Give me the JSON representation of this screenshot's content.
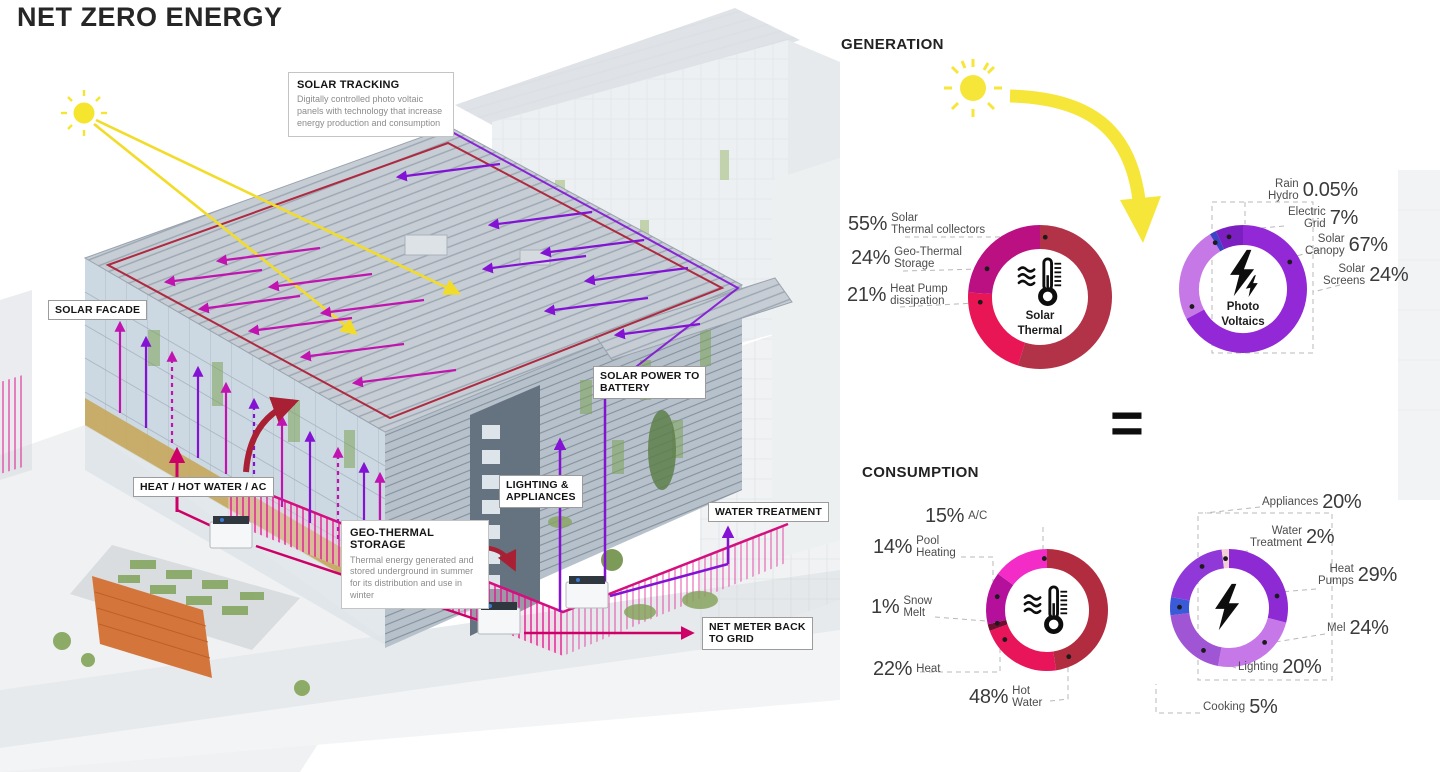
{
  "title": "NET ZERO ENERGY",
  "equals_sign": "=",
  "diagram": {
    "callouts": {
      "solar_tracking": {
        "title": "SOLAR TRACKING",
        "body": "Digitally controlled photo voltaic panels with technology that increase energy production and consumption"
      },
      "geo_thermal": {
        "title": "GEO-THERMAL\nSTORAGE",
        "body": "Thermal energy generated and stored underground in summer for its distribution and use in winter"
      }
    },
    "labels": {
      "solar_facade": "SOLAR  FACADE",
      "heat_hot_water_ac": "HEAT / HOT WATER / AC",
      "solar_power_to_battery": "SOLAR POWER TO\nBATTERY",
      "lighting_appliances": "LIGHTING &\nAPPLIANCES",
      "water_treatment": "WATER TREATMENT",
      "net_meter": "NET METER BACK\nTO GRID"
    }
  },
  "generation": {
    "heading": "GENERATION"
  },
  "consumption": {
    "heading": "CONSUMPTION"
  },
  "chart_data": [
    {
      "id": "gen-thermal",
      "type": "pie",
      "section": "GENERATION",
      "center_label": "Solar\nThermal",
      "icon": "thermometer-icon",
      "segments": [
        {
          "label": "Solar Thermal collectors",
          "value": 55,
          "display_value": "55%",
          "display_name": "Solar\nThermal collectors",
          "color": "#b23247",
          "dot": 5
        },
        {
          "label": "Heat Pump dissipation",
          "value": 21,
          "display_value": "21%",
          "display_name": "Heat Pump\ndissipation",
          "color": "#e91656",
          "dot": 265
        },
        {
          "label": "Geo-Thermal Storage",
          "value": 24,
          "display_value": "24%",
          "display_name": "Geo-Thermal\nStorage",
          "color": "#ba1082",
          "dot": 298
        }
      ]
    },
    {
      "id": "gen-pv",
      "type": "pie",
      "section": "GENERATION",
      "center_label": "Photo\nVoltaics",
      "icon": "lightning-icon",
      "segments": [
        {
          "label": "Solar Canopy",
          "value": 67,
          "display_value": "67%",
          "display_name": "Solar\nCanopy",
          "color": "#9228d6",
          "dot": 60
        },
        {
          "label": "Solar Screens",
          "value": 24,
          "display_value": "24%",
          "display_name": "Solar\nScreens",
          "color": "#c678e6",
          "dot": 251
        },
        {
          "label": "Rain Hydro",
          "value": 0.05,
          "display_value": "0.05%",
          "display_name": "Rain\nHydro",
          "color": "#3a44c4",
          "render": 1.6,
          "dot": 329
        },
        {
          "label": "Electric Grid",
          "value": 7,
          "display_value": "7%",
          "display_name": "Electric\nGrid",
          "color": "#7b1fc0",
          "dot": 345
        }
      ]
    },
    {
      "id": "cons-thermal",
      "type": "pie",
      "section": "CONSUMPTION",
      "center_label": "",
      "icon": "thermometer-icon",
      "segments": [
        {
          "label": "Hot Water",
          "value": 48,
          "display_value": "48%",
          "display_name": "Hot\nWater",
          "color": "#b12c3f",
          "dot": 155
        },
        {
          "label": "Heat",
          "value": 22,
          "display_value": "22%",
          "display_name": "Heat",
          "color": "#e8155b",
          "dot": 235
        },
        {
          "label": "Snow Melt",
          "value": 1,
          "display_value": "1%",
          "display_name": "Snow\nMelt",
          "color": "#6e0f30",
          "render": 1.8,
          "dot": 255
        },
        {
          "label": "Pool Heating",
          "value": 14,
          "display_value": "14%",
          "display_name": "Pool\nHeating",
          "color": "#b5109c",
          "dot": 285
        },
        {
          "label": "A/C",
          "value": 15,
          "display_value": "15%",
          "display_name": "A/C",
          "color": "#f32bc7",
          "dot": 357
        }
      ]
    },
    {
      "id": "cons-electric",
      "type": "pie",
      "section": "CONSUMPTION",
      "center_label": "",
      "icon": "lightning-icon",
      "segments": [
        {
          "label": "Heat Pumps",
          "value": 29,
          "display_value": "29%",
          "display_name": "Heat\nPumps",
          "color": "#8e2ad4",
          "dot": 76
        },
        {
          "label": "Mel",
          "value": 24,
          "display_value": "24%",
          "display_name": "Mel",
          "color": "#c678e8",
          "dot": 134
        },
        {
          "label": "Lighting",
          "value": 20,
          "display_value": "20%",
          "display_name": "Lighting",
          "color": "#a055d4",
          "dot": 211
        },
        {
          "label": "Cooking",
          "value": 5,
          "display_value": "5%",
          "display_name": "Cooking",
          "color": "#3b5ad8",
          "dot": 271
        },
        {
          "label": "Appliances",
          "value": 20,
          "display_value": "20%",
          "display_name": "Appliances",
          "color": "#9138d8",
          "dot": 327
        },
        {
          "label": "Water Treatment",
          "value": 2,
          "display_value": "2%",
          "display_name": "Water\nTreatment",
          "color": "#f3d0d6",
          "dot": 356
        }
      ]
    }
  ]
}
